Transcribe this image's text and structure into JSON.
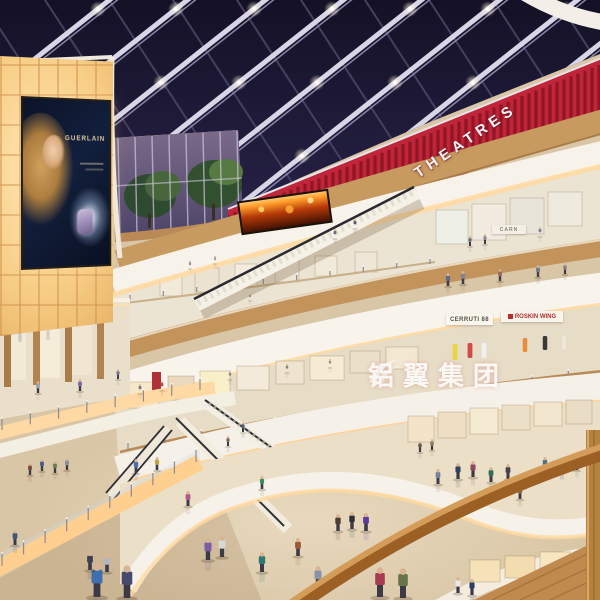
{
  "image": {
    "type": "architectural rendering",
    "description": "Interior visualization of a multi-level shopping mall atrium at dusk: dark glazed skylight with lit beams, red slatted cinema band labelled THEATRES, curved white balcony fascias with cove lighting, escalators crossing the void, backlit amber panel wall with a perfume billboard, storefronts with mannequins, crowds on reflective beige floors and a wooden foreground handrail"
  },
  "signs": {
    "theatres": "THEATRES",
    "watermark": "铝翼集团",
    "billboard_brand": "GUERLAIN",
    "store_sign_1": "CERRUTI 88",
    "store_sign_2": "ROSKIN WING",
    "store_sign_3": "CARN"
  },
  "palette": {
    "skylight": "#1d1a36",
    "skylight_deep": "#141126",
    "beam": "#d8d5e6",
    "beam_dark": "#44405e",
    "theatre_red": "#c0253a",
    "slat_red": "#8f1624",
    "fascia": "#f7f3ea",
    "glow": "#ffd9a0",
    "glow_deep": "#ffc87a",
    "wood_band": "#c79a5f",
    "handrail": "#9c5f24",
    "handrail_hi": "#d9a35f",
    "floor": "#e8dbc0",
    "floor_lower": "#d9c6a6",
    "backlit": "#ffd99a",
    "sky_glass_top": "#7b6a8a",
    "sky_glass_bot": "#4a4266",
    "tree": "#3f5f38",
    "fire_ad": "#ff9c2a",
    "skin": "#d8b494"
  },
  "figures": [
    [
      97,
      597,
      34,
      "#3f6fb0"
    ],
    [
      127,
      598,
      33,
      "#474a6e"
    ],
    [
      208,
      560,
      22,
      "#7d5ba6"
    ],
    [
      222,
      557,
      21,
      "#d8d8d8"
    ],
    [
      262,
      572,
      20,
      "#2f7a70"
    ],
    [
      318,
      588,
      22,
      "#8893a8"
    ],
    [
      298,
      556,
      18,
      "#9a5a3a"
    ],
    [
      338,
      531,
      17,
      "#4a3f33"
    ],
    [
      352,
      529,
      17,
      "#303038"
    ],
    [
      366,
      531,
      18,
      "#5a3a9c"
    ],
    [
      380,
      597,
      30,
      "#a43b4e"
    ],
    [
      403,
      598,
      30,
      "#65744a"
    ],
    [
      90,
      570,
      18,
      "#3f3f52"
    ],
    [
      107,
      572,
      18,
      "#b0b6c2"
    ],
    [
      15,
      545,
      15,
      "#45557a"
    ],
    [
      136,
      473,
      14,
      "#4a6fae"
    ],
    [
      157,
      470,
      13,
      "#c2a53a"
    ],
    [
      188,
      506,
      15,
      "#b05a8c"
    ],
    [
      262,
      489,
      13,
      "#3a8c5a"
    ],
    [
      438,
      484,
      15,
      "#7a829a"
    ],
    [
      458,
      479,
      16,
      "#31425f"
    ],
    [
      473,
      477,
      16,
      "#8a4a5f"
    ],
    [
      491,
      482,
      15,
      "#2f6f5a"
    ],
    [
      508,
      479,
      15,
      "#44444c"
    ],
    [
      545,
      471,
      14,
      "#4f6f8c"
    ],
    [
      562,
      472,
      14,
      "#2b2b33"
    ],
    [
      577,
      470,
      13,
      "#6f8c4f"
    ],
    [
      520,
      499,
      14,
      "#8c6a4a"
    ],
    [
      30,
      475,
      12,
      "#7a4a3a"
    ],
    [
      42,
      471,
      12,
      "#4a5a8c"
    ],
    [
      55,
      473,
      12,
      "#6a7a5a"
    ],
    [
      67,
      470,
      12,
      "#8c8c9c"
    ],
    [
      458,
      593,
      16,
      "#e8e8ea"
    ],
    [
      472,
      595,
      16,
      "#2f3f5f"
    ],
    [
      420,
      452,
      11,
      "#6a5a4a"
    ],
    [
      432,
      450,
      11,
      "#8a7a6a"
    ],
    [
      448,
      286,
      13,
      "#5a6a8c"
    ],
    [
      463,
      284,
      13,
      "#7b8498"
    ],
    [
      500,
      281,
      12,
      "#996a55"
    ],
    [
      538,
      277,
      12,
      "#6f7788"
    ],
    [
      565,
      274,
      11,
      "#8a8272"
    ],
    [
      140,
      393,
      9,
      "#7a7a82"
    ],
    [
      162,
      390,
      9,
      "#a45548"
    ],
    [
      230,
      379,
      8,
      "#85858f"
    ],
    [
      330,
      367,
      8,
      "#9595a2"
    ],
    [
      287,
      372,
      8,
      "#7a8a7a"
    ],
    [
      250,
      300,
      7,
      "#8a8a95"
    ],
    [
      215,
      263,
      7,
      "#9a9aa5"
    ],
    [
      190,
      268,
      7,
      "#85859a"
    ],
    [
      38,
      393,
      12,
      "#9aa3b5"
    ],
    [
      80,
      391,
      12,
      "#7a6a9a"
    ],
    [
      118,
      379,
      10,
      "#6a7a8a"
    ],
    [
      470,
      246,
      10,
      "#6a7288"
    ],
    [
      485,
      244,
      10,
      "#8c8298"
    ],
    [
      540,
      236,
      9,
      "#7a8290"
    ],
    [
      243,
      432,
      10,
      "#556077"
    ],
    [
      228,
      446,
      10,
      "#7a6455"
    ],
    [
      335,
      238,
      9,
      "#6a6a78"
    ],
    [
      355,
      228,
      9,
      "#58586a"
    ]
  ],
  "mannequins": [
    [
      455,
      360,
      16,
      "#e8d44a"
    ],
    [
      470,
      358,
      15,
      "#d04a4a"
    ],
    [
      484,
      358,
      15,
      "#f0f0f0"
    ],
    [
      525,
      352,
      14,
      "#e88c3a"
    ],
    [
      545,
      350,
      14,
      "#3a3a3a"
    ],
    [
      564,
      349,
      13,
      "#efe6dc"
    ],
    [
      20,
      342,
      10,
      "#c8c8c8"
    ],
    [
      48,
      340,
      10,
      "#d8d0c0"
    ]
  ],
  "shops": {
    "far_wall": [
      [
        125,
        382,
        34,
        26,
        "#f7e7c9"
      ],
      [
        168,
        376,
        26,
        24,
        "#e9d9bf"
      ],
      [
        200,
        371,
        30,
        25,
        "#f9efc9"
      ],
      [
        237,
        366,
        32,
        24,
        "#f3ead9"
      ],
      [
        276,
        361,
        28,
        23,
        "#efe4cf"
      ],
      [
        310,
        356,
        34,
        24,
        "#f6ecd4"
      ],
      [
        350,
        351,
        30,
        22,
        "#eadfc9"
      ],
      [
        386,
        347,
        32,
        22,
        "#f2e8d2"
      ]
    ],
    "upper_wall": [
      [
        160,
        272,
        22,
        24,
        "#f1e9d9"
      ],
      [
        195,
        268,
        24,
        24,
        "#ece2d0"
      ],
      [
        235,
        264,
        22,
        22,
        "#f4ecdc"
      ],
      [
        275,
        260,
        24,
        22,
        "#ece4d4"
      ],
      [
        315,
        256,
        22,
        20,
        "#f2ead8"
      ],
      [
        355,
        252,
        22,
        20,
        "#eee6d6"
      ]
    ],
    "level4": [
      [
        436,
        210,
        32,
        34,
        "#eef0e8"
      ],
      [
        472,
        204,
        34,
        36,
        "#f2ece0"
      ],
      [
        510,
        198,
        34,
        36,
        "#e8e4da"
      ],
      [
        548,
        192,
        34,
        34,
        "#efeade"
      ]
    ],
    "level2": [
      [
        408,
        416,
        26,
        26,
        "#f3e4c9"
      ],
      [
        438,
        412,
        28,
        26,
        "#efe0c5"
      ],
      [
        470,
        408,
        28,
        26,
        "#f5ead2"
      ],
      [
        502,
        405,
        28,
        25,
        "#ece0c8"
      ],
      [
        534,
        402,
        28,
        24,
        "#f2e6ce"
      ],
      [
        566,
        400,
        26,
        24,
        "#e9ddc5"
      ]
    ],
    "bottom": [
      [
        470,
        560,
        30,
        22,
        "#f6e2b8"
      ],
      [
        505,
        556,
        30,
        22,
        "#f3ddb0"
      ],
      [
        540,
        552,
        30,
        22,
        "#f8e6c0"
      ]
    ]
  },
  "banner": {
    "x": 152,
    "y": 372,
    "w": 9,
    "h": 26,
    "color": "#b03038"
  }
}
